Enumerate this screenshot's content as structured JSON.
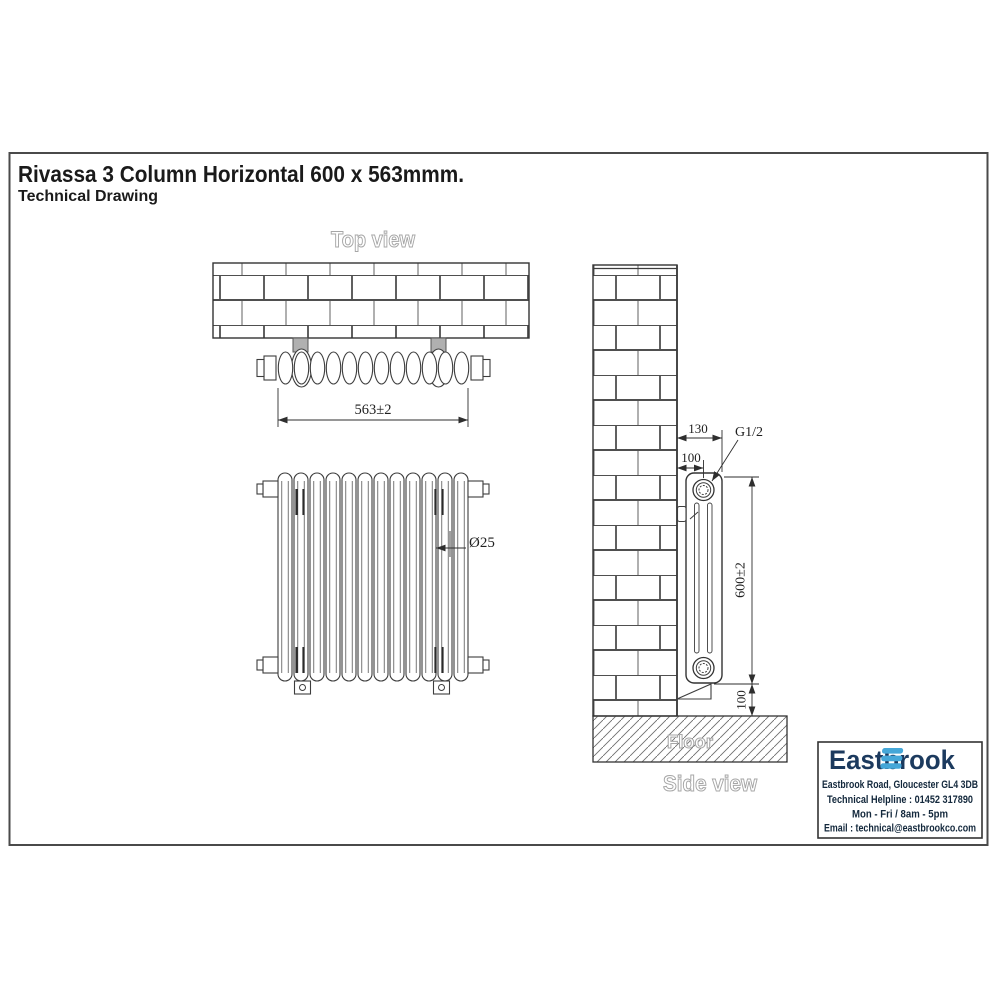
{
  "page": {
    "title": "Rivassa 3 Column Horizontal 600 x 563mmm.",
    "subtitle": "Technical Drawing"
  },
  "views": {
    "top_label": "Top view",
    "side_label": "Side view",
    "floor_label": "Floor"
  },
  "dims": {
    "width": "563±2",
    "column_diameter": "Ø25",
    "wall_depth": "130",
    "pipe_centre": "100",
    "connection": "G1/2",
    "height": "600±2",
    "floor_clearance": "100"
  },
  "brand": {
    "name": "Eastbrook",
    "address": "Eastbrook Road, Gloucester GL4 3DB",
    "helpline": "Technical Helpline : 01452 317890",
    "hours": "Mon - Fri / 8am - 5pm",
    "email": "Email : technical@eastbrookco.com",
    "colors": {
      "navy": "#1c3a5e",
      "blue": "#45a7d8"
    }
  },
  "icons": {
    "logo_mark": "eastbrook-waves-icon"
  }
}
